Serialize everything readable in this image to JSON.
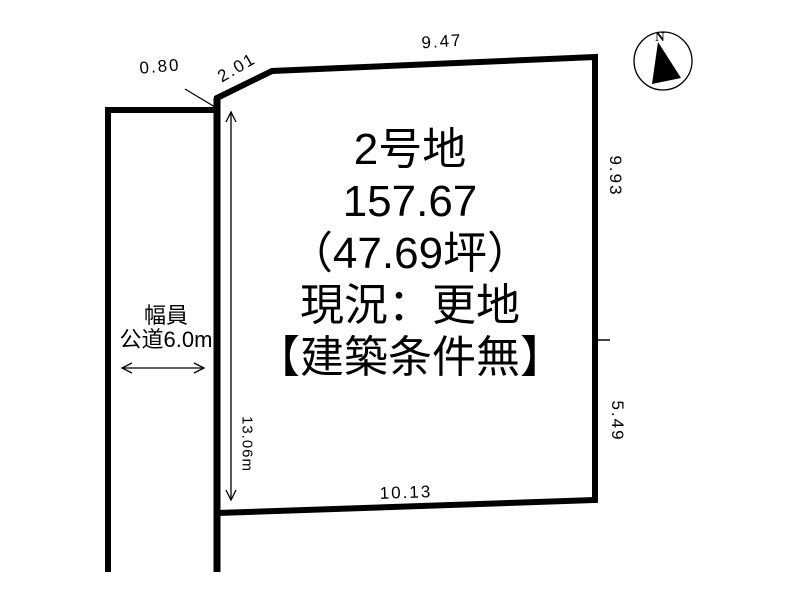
{
  "parcel": {
    "name": "2号地",
    "area_sqm": "157.67",
    "area_tsubo": "（47.69坪）",
    "status": "現況：更地",
    "condition": "【建築条件無】"
  },
  "dimensions": {
    "top_offset": "0.80",
    "top_diagonal": "2.01",
    "top_edge": "9.47",
    "right_upper": "9.93",
    "right_lower": "5.49",
    "bottom_edge": "10.13",
    "left_depth": "13.06m"
  },
  "road": {
    "label_line1": "幅員",
    "label_line2": "公道6.0m"
  },
  "compass": {
    "north": "N"
  },
  "colors": {
    "line": "#000000",
    "background": "#ffffff"
  }
}
